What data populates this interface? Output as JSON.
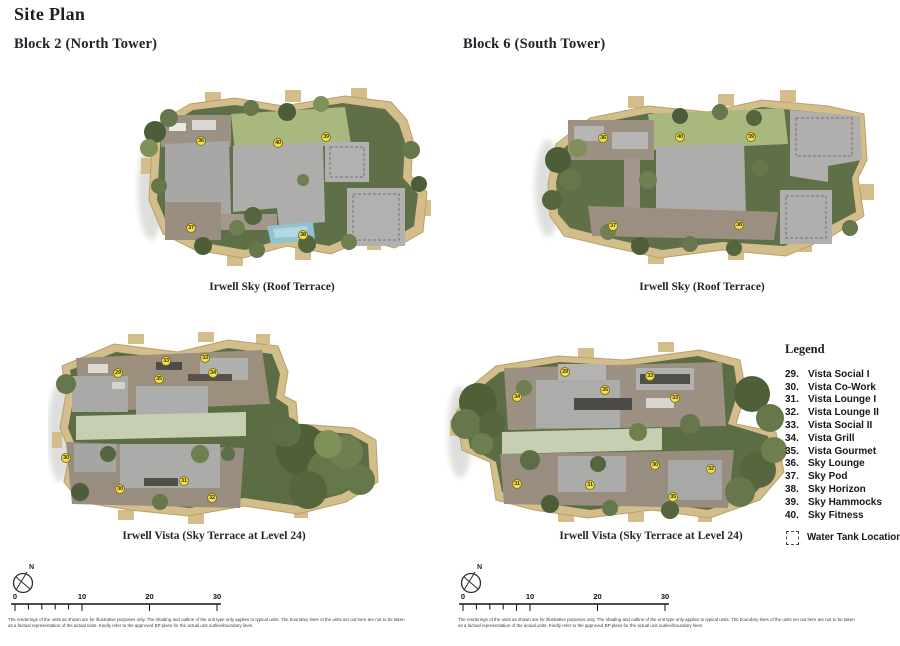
{
  "page": {
    "title": "Site Plan"
  },
  "sections": {
    "left_heading": "Block 2 (North Tower)",
    "right_heading": "Block 6 (South Tower)"
  },
  "plans": [
    {
      "name": "block2-roof-terrace",
      "caption": "Irwell Sky (Roof Terrace)",
      "markers": [
        {
          "n": "36",
          "x": 66,
          "y": 53
        },
        {
          "n": "40",
          "x": 143,
          "y": 55
        },
        {
          "n": "39",
          "x": 191,
          "y": 49
        },
        {
          "n": "37",
          "x": 56,
          "y": 140
        },
        {
          "n": "38",
          "x": 168,
          "y": 147
        }
      ]
    },
    {
      "name": "block6-roof-terrace",
      "caption": "Irwell Sky (Roof Terrace)",
      "markers": [
        {
          "n": "36",
          "x": 75,
          "y": 50
        },
        {
          "n": "40",
          "x": 152,
          "y": 49
        },
        {
          "n": "39",
          "x": 223,
          "y": 49
        },
        {
          "n": "37",
          "x": 85,
          "y": 138
        },
        {
          "n": "38",
          "x": 211,
          "y": 137
        }
      ]
    },
    {
      "name": "block2-sky-terrace-level24",
      "caption": "Irwell Vista (Sky Terrace at Level 24)",
      "markers": [
        {
          "n": "29",
          "x": 70,
          "y": 41
        },
        {
          "n": "33",
          "x": 118,
          "y": 29
        },
        {
          "n": "33",
          "x": 157,
          "y": 26
        },
        {
          "n": "34",
          "x": 165,
          "y": 41
        },
        {
          "n": "35",
          "x": 111,
          "y": 47
        },
        {
          "n": "30",
          "x": 18,
          "y": 126
        },
        {
          "n": "30",
          "x": 72,
          "y": 157
        },
        {
          "n": "31",
          "x": 136,
          "y": 149
        },
        {
          "n": "32",
          "x": 164,
          "y": 166
        }
      ]
    },
    {
      "name": "block6-sky-terrace-level24",
      "caption": "Irwell Vista (Sky Terrace at Level 24)",
      "markers": [
        {
          "n": "34",
          "x": 79,
          "y": 65
        },
        {
          "n": "29",
          "x": 127,
          "y": 40
        },
        {
          "n": "35",
          "x": 167,
          "y": 58
        },
        {
          "n": "33",
          "x": 212,
          "y": 44
        },
        {
          "n": "33",
          "x": 237,
          "y": 66
        },
        {
          "n": "30",
          "x": 217,
          "y": 133
        },
        {
          "n": "32",
          "x": 273,
          "y": 137
        },
        {
          "n": "31",
          "x": 79,
          "y": 152
        },
        {
          "n": "31",
          "x": 152,
          "y": 153
        },
        {
          "n": "35",
          "x": 235,
          "y": 165
        }
      ]
    }
  ],
  "legend": {
    "title": "Legend",
    "items": [
      {
        "num": "29.",
        "label": "Vista Social I"
      },
      {
        "num": "30.",
        "label": "Vista Co-Work"
      },
      {
        "num": "31.",
        "label": "Vista Lounge I"
      },
      {
        "num": "32.",
        "label": "Vista Lounge II"
      },
      {
        "num": "33.",
        "label": "Vista Social II"
      },
      {
        "num": "34.",
        "label": "Vista Grill"
      },
      {
        "num": "35.",
        "label": "Vista Gourmet"
      },
      {
        "num": "36.",
        "label": "Sky Lounge"
      },
      {
        "num": "37.",
        "label": "Sky Pod"
      },
      {
        "num": "38.",
        "label": "Sky Horizon"
      },
      {
        "num": "39.",
        "label": "Sky Hammocks"
      },
      {
        "num": "40.",
        "label": "Sky Fitness"
      }
    ],
    "water_tank": "Water Tank Location"
  },
  "compass": {
    "n": "N"
  },
  "scale": {
    "labels": [
      "0",
      "10",
      "20",
      "30"
    ]
  },
  "disclaimer": {
    "line1": "The renderings of the units as shown are for illustrative purposes only. The shading and outline of the unit type only applies to typical units. The boundary lines of the units set out here are not to be taken",
    "line2": "as a factual representation of the actual units. Kindly refer to the approved BP plans for the actual unit outline/boundary lines."
  },
  "colors": {
    "marker_fill": "#f2e24e",
    "boundary_tan": "#d3bd8b",
    "roof_gray": "#acacaa",
    "vegetation_green": "#5f7048",
    "lawn_green": "#a9b97e",
    "water_blue": "#8fc3d4"
  }
}
